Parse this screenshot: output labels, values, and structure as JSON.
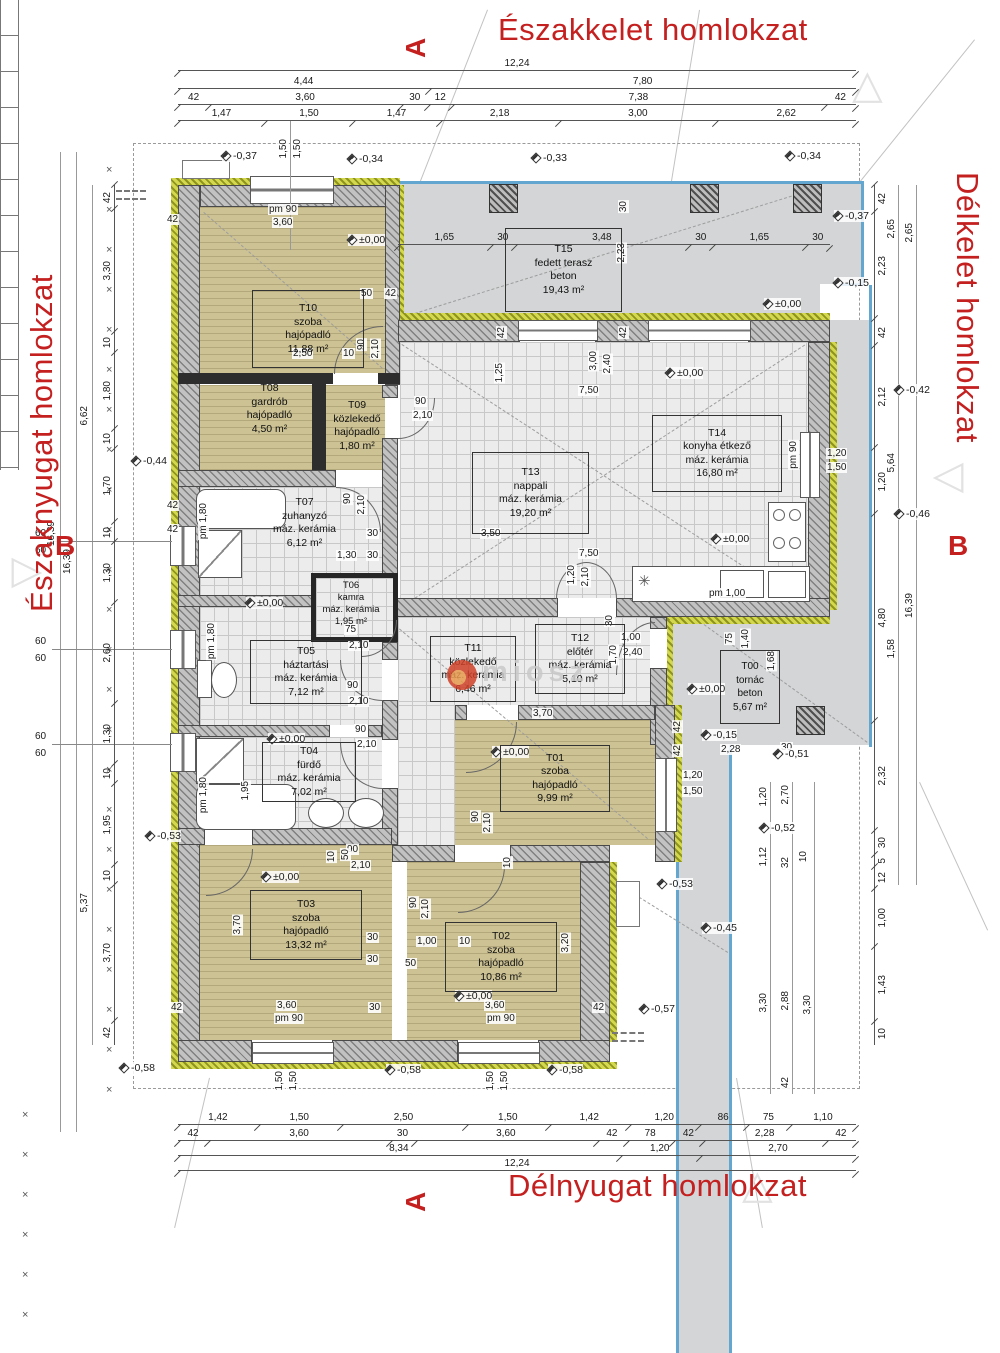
{
  "titles": {
    "top": "Északkelet homlokzat",
    "bottom": "Délnyugat homlokzat",
    "left": "Északnyugat homlokzat",
    "right": "Délkelet homlokzat"
  },
  "section_markers": {
    "a": "A",
    "b": "B"
  },
  "watermark": {
    "text": "miosz"
  },
  "rooms": [
    {
      "id": "T00",
      "name": "tornác",
      "floor": "beton",
      "area": "5,67 m²"
    },
    {
      "id": "T01",
      "name": "szoba",
      "floor": "hajópadló",
      "area": "9,99 m²"
    },
    {
      "id": "T02",
      "name": "szoba",
      "floor": "hajópadló",
      "area": "10,86 m²"
    },
    {
      "id": "T03",
      "name": "szoba",
      "floor": "hajópadló",
      "area": "13,32 m²"
    },
    {
      "id": "T04",
      "name": "fürdő",
      "floor": "máz. kerámia",
      "area": "7,02 m²"
    },
    {
      "id": "T05",
      "name": "háztartási",
      "floor": "máz. kerámia",
      "area": "7,12 m²"
    },
    {
      "id": "T06",
      "name": "kamra",
      "floor": "máz. kerámia",
      "area": "1,95 m²"
    },
    {
      "id": "T07",
      "name": "zuhanyzó",
      "floor": "máz. kerámia",
      "area": "6,12 m²"
    },
    {
      "id": "T08",
      "name": "gardrób",
      "floor": "hajópadló",
      "area": "4,50 m²"
    },
    {
      "id": "T09",
      "name": "közlekedő",
      "floor": "hajópadló",
      "area": "1,80 m²"
    },
    {
      "id": "T10",
      "name": "szoba",
      "floor": "hajópadló",
      "area": "11,88 m²"
    },
    {
      "id": "T11",
      "name": "közlekedő",
      "floor": "máz. kerámia",
      "area": "6,46 m²"
    },
    {
      "id": "T12",
      "name": "előtér",
      "floor": "máz. kerámia",
      "area": "5,10 m²"
    },
    {
      "id": "T13",
      "name": "nappali",
      "floor": "máz. kerámia",
      "area": "19,20 m²"
    },
    {
      "id": "T14",
      "name": "konyha étkező",
      "floor": "máz. kerámia",
      "area": "16,80 m²"
    },
    {
      "id": "T15",
      "name": "fedett terasz",
      "floor": "beton",
      "area": "19,43 m²"
    }
  ],
  "dims": {
    "top_rows": [
      [
        "12,24"
      ],
      [
        "4,44",
        "7,80"
      ],
      [
        "42",
        "3,60",
        "30",
        "12",
        "7,38",
        "42"
      ],
      [
        "1,47",
        "1,50",
        "1,47",
        "2,18",
        "3,00",
        "2,62"
      ]
    ],
    "bottom_rows": [
      [
        "1,42",
        "1,50",
        "2,50",
        "1,50",
        "1,42",
        "1,20",
        "86",
        "75",
        "1,10"
      ],
      [
        "42",
        "3,60",
        "30",
        "3,60",
        "42",
        "78",
        "42",
        "2,28",
        "42"
      ],
      [
        "8,34",
        "1,20",
        "2,70"
      ],
      [
        "12,24"
      ]
    ],
    "terrace_row": [
      "1,65",
      "30",
      "3,48",
      "30",
      "1,65",
      "30"
    ],
    "left_chain": [
      "42",
      "3,30",
      "10",
      "1,80",
      "10",
      "1,70",
      "10",
      "1,30",
      "2,60",
      "1,30",
      "10",
      "1,95",
      "10",
      "3,70",
      "42"
    ],
    "left_mid": [
      "6,62",
      "5,37"
    ],
    "left_totals": [
      "16,39",
      "16,39"
    ],
    "right_chain": [
      "42",
      "2,23",
      "42",
      "2,12",
      "1,20",
      "4,80",
      "2,32",
      "30",
      "5",
      "12",
      "1,00",
      "1,43",
      "10"
    ],
    "right_col2": [
      "2,65",
      "5,64",
      "1,58"
    ],
    "right_col3": [
      "2,65",
      "16,39"
    ],
    "right_lower": [
      "1,20",
      "2,70",
      "1,12",
      "32",
      "10",
      "3,30",
      "2,88",
      "3,30",
      "42"
    ]
  },
  "labels": {
    "pm90": "pm 90",
    "pm180": "pm 1,80",
    "pm100": "pm 1,00",
    "l150": "1,50",
    "l360": "3,60",
    "l42": "42",
    "l50": "50",
    "l30": "30",
    "l10": "10",
    "l12": "12",
    "l250": "2,50",
    "l90": "90",
    "l210": "2,10",
    "l125": "1,25",
    "l300": "3,00",
    "l240": "2,40",
    "l750": "7,50",
    "l350": "3,50",
    "l223": "2,23",
    "l120": "1,20",
    "l130": "1,30",
    "l75": "75",
    "l100": "1,00",
    "l170": "1,70",
    "l140": "1,40",
    "l168": "1,68",
    "l228": "2,28",
    "l370": "3,70",
    "l320": "3,20",
    "l195": "1,95",
    "l60": "60"
  },
  "levels": {
    "p0": "±0,00",
    "m15": "-0,15",
    "m33": "-0,33",
    "m34": "-0,34",
    "m37": "-0,37",
    "m42": "-0,42",
    "m44": "-0,44",
    "m45": "-0,45",
    "m46": "-0,46",
    "m51": "-0,51",
    "m52": "-0,52",
    "m53": "-0,53",
    "m57": "-0,57",
    "m58": "-0,58"
  }
}
